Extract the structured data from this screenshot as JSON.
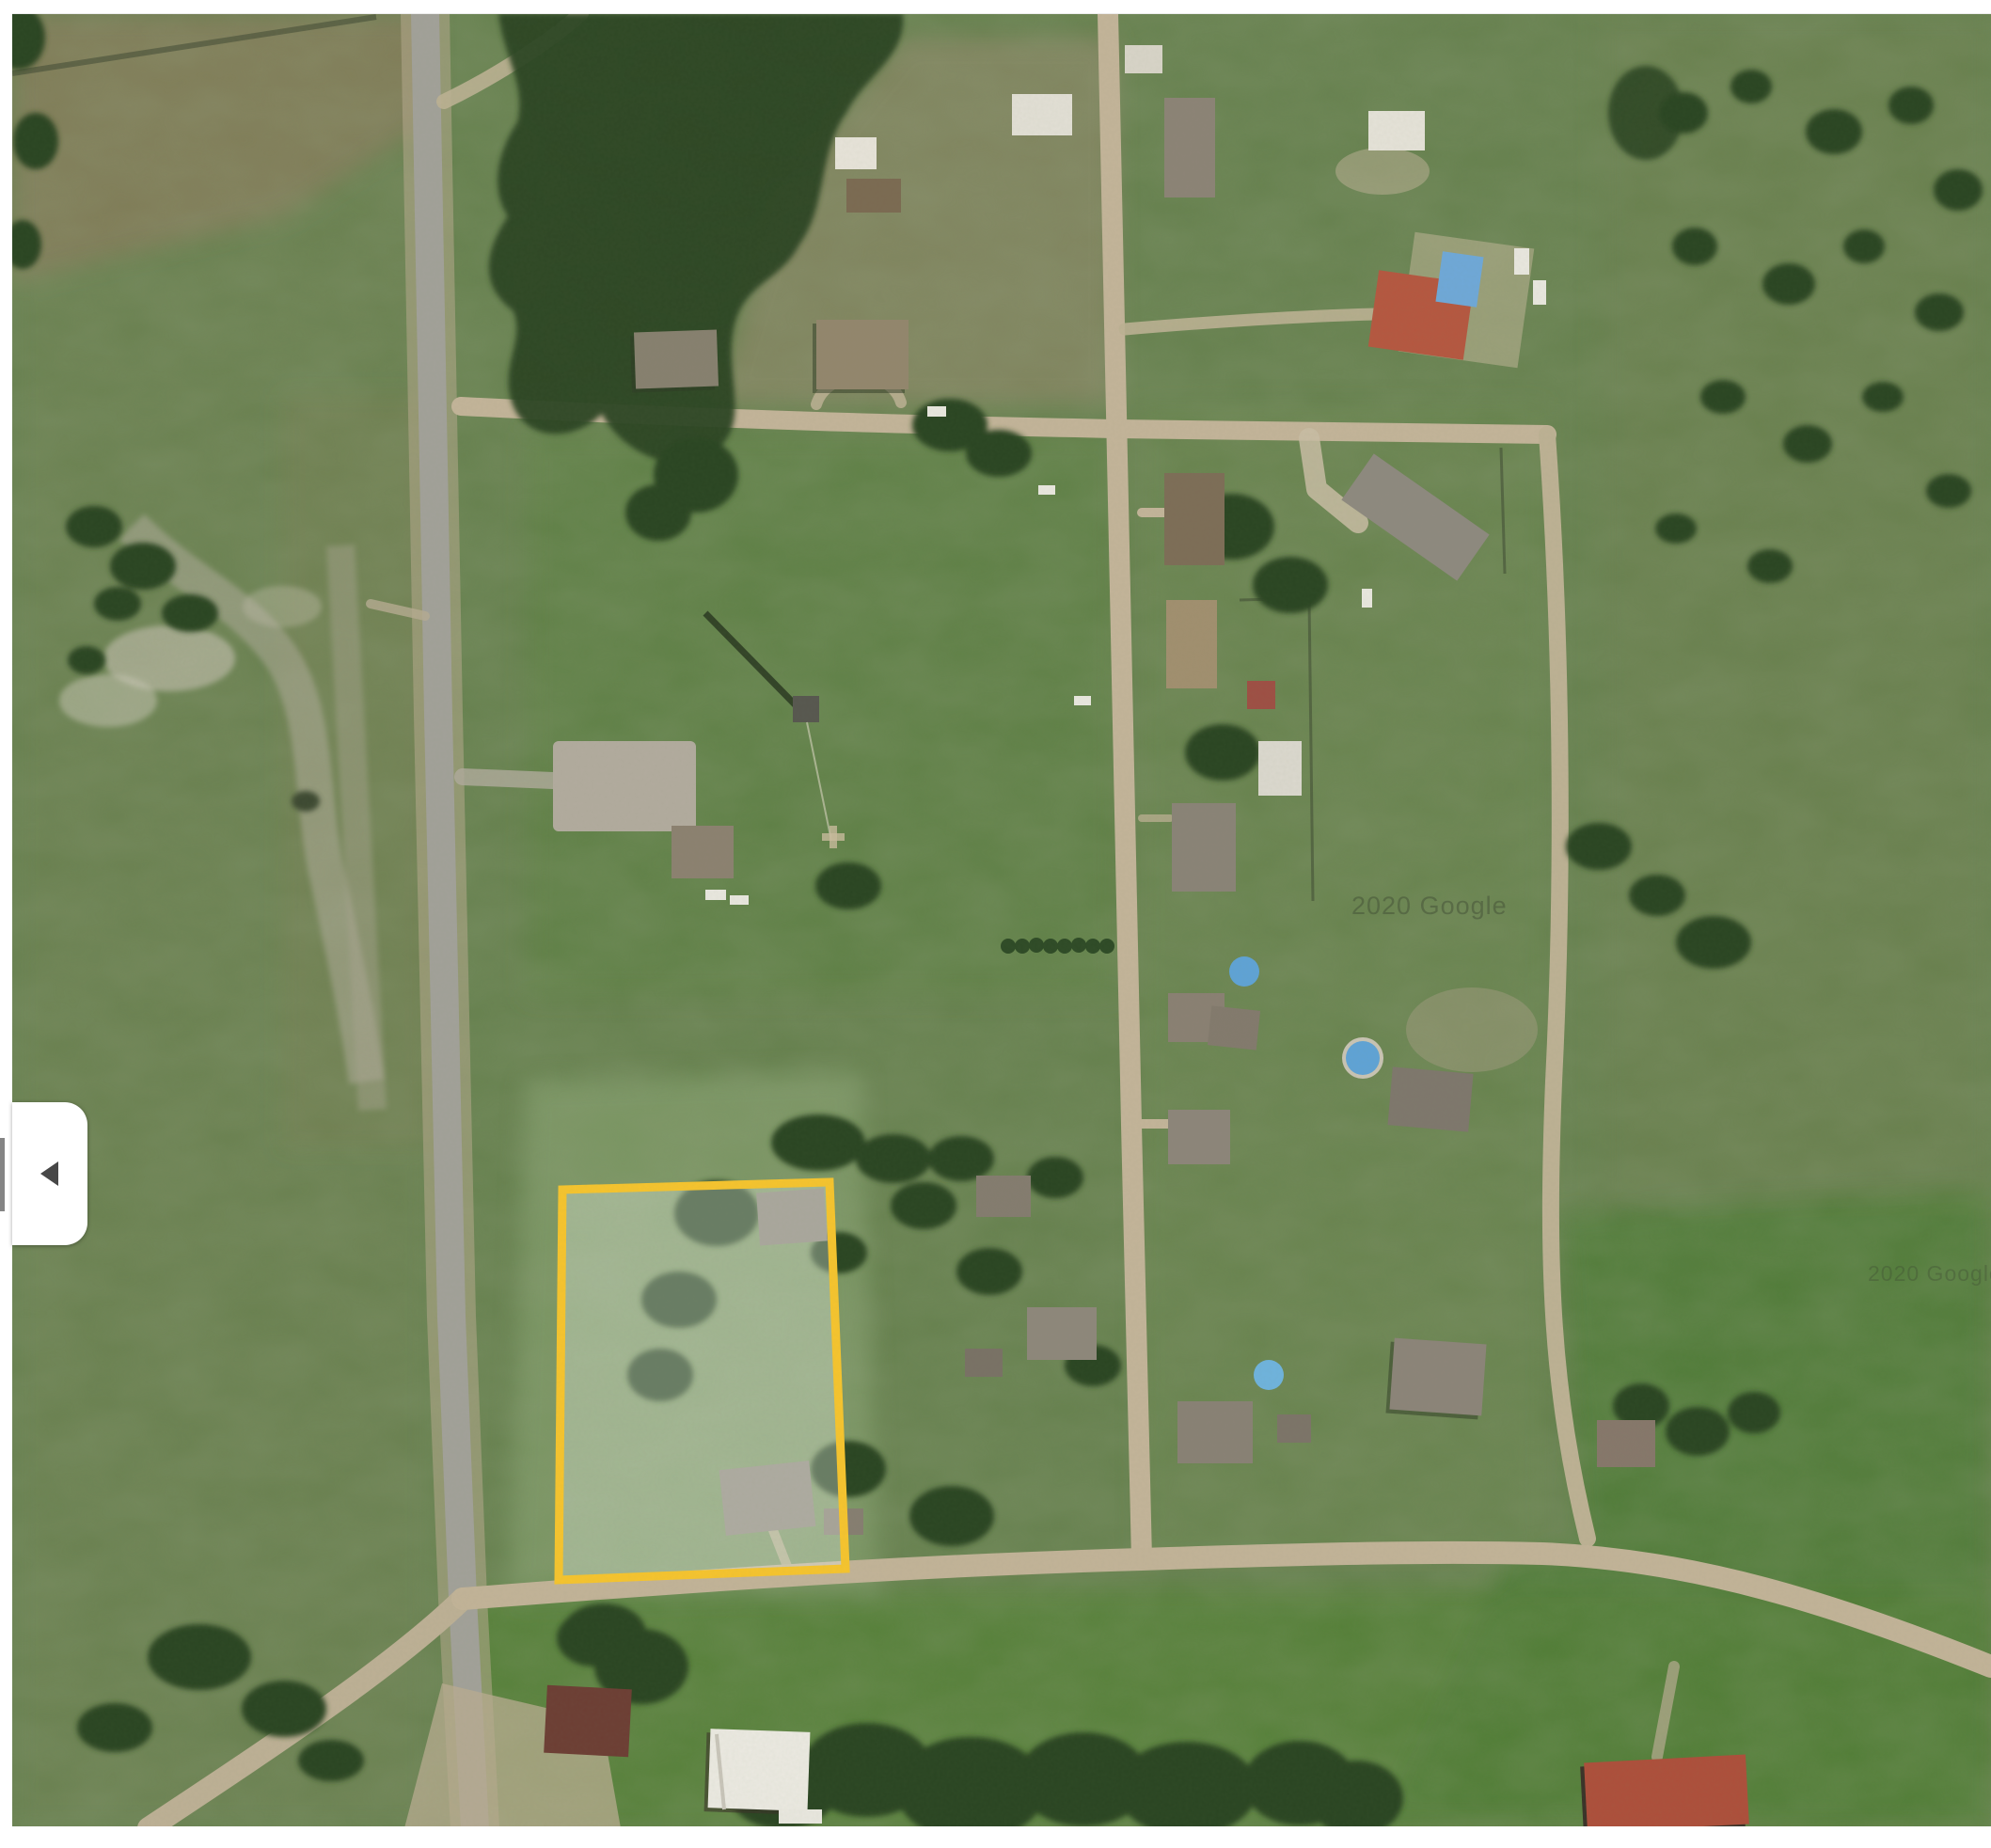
{
  "map": {
    "view_type": "satellite-imagery",
    "watermark": {
      "primary": "2020 Google",
      "secondary": "2020 Google"
    },
    "parcel_highlight": {
      "outline_color": "#F6C42E",
      "fill_color": "rgba(240,246,238,0.32)"
    },
    "palette": {
      "field_green": "#66814E",
      "forest_green": "#2B4522",
      "paved_road_gray": "#A2A199",
      "dirt_road_tan": "#C3B499",
      "pool_blue": "#5FA3D6",
      "red_roof": "#B55740"
    }
  },
  "side_panel_toggle": {
    "icon": "chevron-left-icon"
  }
}
